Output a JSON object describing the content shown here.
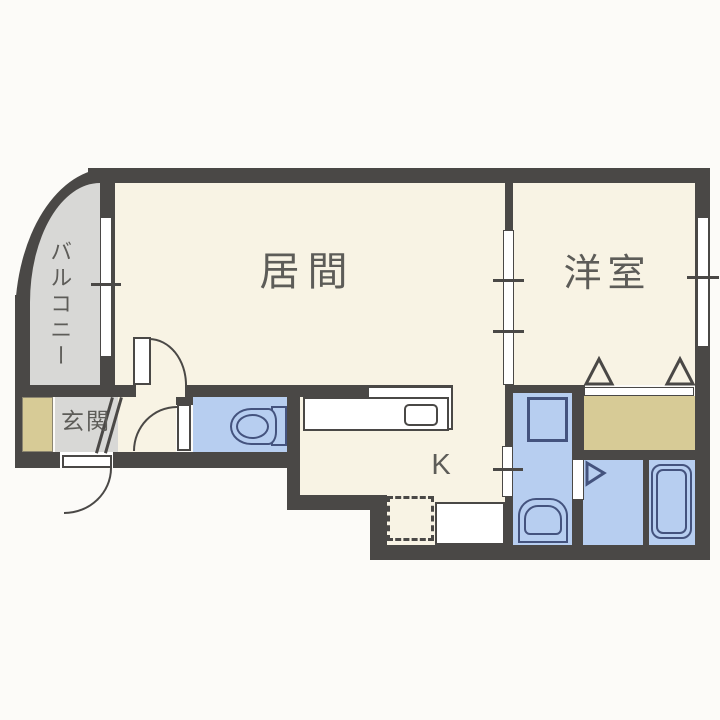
{
  "plan": {
    "title": "1DK apartment floor plan",
    "labels": {
      "living": "居間",
      "western_room": "洋室",
      "balcony": "バルコニー",
      "entrance": "玄関",
      "kitchen": "K"
    },
    "colors": {
      "wall": "#4a4846",
      "floor": "#f8f3e4",
      "water_blue": "#b7cef0",
      "fixture_outline": "#44537e",
      "balcony_gray": "#d8d8d6",
      "closet_tan": "#d7cb96",
      "label_text": "#5d5c58"
    },
    "fixtures": [
      "kitchen-counter",
      "kitchen-sink",
      "refrigerator-space",
      "toilet",
      "washing-machine",
      "washbasin",
      "bathtub",
      "closet",
      "shoe-cabinet"
    ]
  }
}
